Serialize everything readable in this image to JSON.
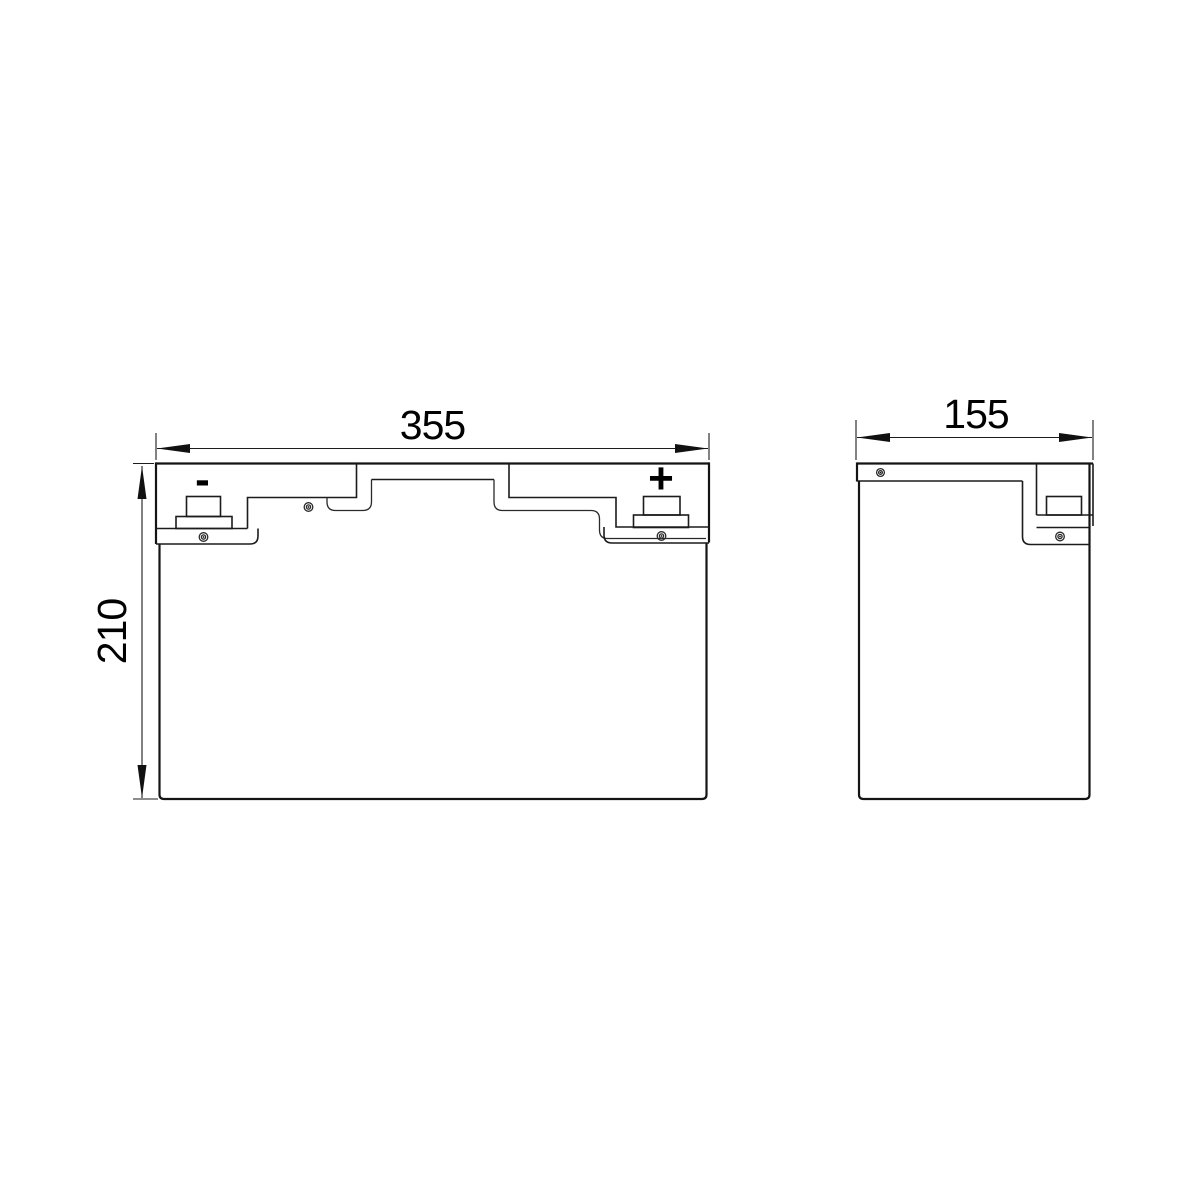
{
  "drawing": {
    "width_mm": "355",
    "height_mm": "210",
    "depth_mm": "155",
    "negative_terminal_symbol": "-",
    "positive_terminal_symbol": "+",
    "line_color": "#141414",
    "background_color": "#ffffff"
  }
}
